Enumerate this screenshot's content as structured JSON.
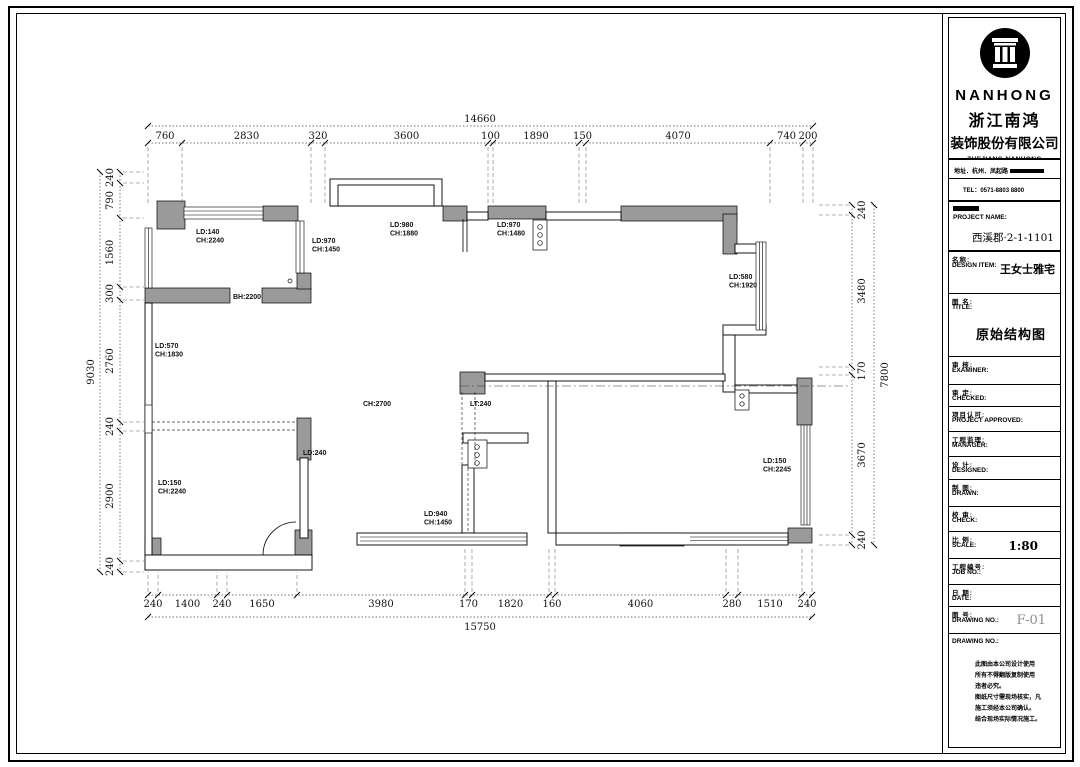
{
  "company": {
    "name_en": "NANHONG",
    "name_cn_1": "浙江南鸿",
    "name_cn_2": "装饰股份有限公司",
    "full_en_1": "ZHEJIANG NANHONG",
    "full_en_2": "INTERIOR DESIGN &",
    "full_en_3": "CONSTRUCTION CO.,LTD",
    "address": "地址．杭州．凤起路",
    "tel": "TEL：0571-8803 8800"
  },
  "fields": {
    "project_name_label": "PROJECT NAME:",
    "project_name_value": "西溪郡·2-1-1101",
    "design_item_cn": "名称:",
    "design_item_en": "DESIGN ITEM:",
    "design_item_value": "王女士雅宅",
    "title_cn": "图 名:",
    "title_en": "TITLE:",
    "title_value": "原始结构图",
    "examiner_cn": "审 核:",
    "examiner_en": "EXAMINER:",
    "checked_cn": "审 定:",
    "checked_en": "CHECKED:",
    "approved_cn": "项目认可:",
    "approved_en": "PROJECT APPROVED:",
    "manager_cn": "工程监理:",
    "manager_en": "MANAGER:",
    "designed_cn": "设 计:",
    "designed_en": "DESIGNED:",
    "drawn_cn": "制 图:",
    "drawn_en": "DRAWN:",
    "check_cn": "校 审:",
    "check_en": "CHECK:",
    "scale_cn": "比 例:",
    "scale_en": "SCALE:",
    "scale_value": "1:80",
    "job_cn": "工程编号:",
    "job_en": "JOB NO.:",
    "date_cn": "日 期:",
    "date_en": "DATE:",
    "dwg_cn": "图 号:",
    "dwg_en": "DRAWING NO.:",
    "dwg_value": "F-01",
    "notes_header": "DRAWING NO.:",
    "notes": "此图由本公司设计使用\n所有不得翻版复制使用\n违者必究。\n图纸尺寸需现场核实，凡\n施工须经本公司确认。\n结合现场实际情况施工。"
  },
  "plan": {
    "dims": {
      "top_total": "14660",
      "top": [
        "760",
        "2830",
        "320",
        "3600",
        "100",
        "1890",
        "150",
        "4070",
        "740",
        "200"
      ],
      "bottom": [
        "240",
        "1400",
        "240",
        "1650",
        "3980",
        "170",
        "1820",
        "160",
        "4060",
        "280",
        "1510",
        "240"
      ],
      "bottom_total": "15750",
      "left_total": "9030",
      "left": [
        "240",
        "790",
        "1560",
        "300",
        "2760",
        "240",
        "2900",
        "240"
      ],
      "right_total": "7800",
      "right": [
        "240",
        "3480",
        "170",
        "3670",
        "240"
      ]
    },
    "labels": [
      {
        "lines": [
          "LD:140",
          "CH:2240"
        ]
      },
      {
        "lines": [
          "LD:970",
          "CH:1450"
        ]
      },
      {
        "lines": [
          "LD:980",
          "CH:1880"
        ]
      },
      {
        "lines": [
          "LD:970",
          "CH:1480"
        ]
      },
      {
        "lines": [
          "LD:580",
          "CH:1920"
        ]
      },
      {
        "lines": [
          "BH:2200"
        ]
      },
      {
        "lines": [
          "LD:570",
          "CH:1830"
        ]
      },
      {
        "lines": [
          "CH:2700"
        ]
      },
      {
        "lines": [
          "LT:240"
        ]
      },
      {
        "lines": [
          "LD:240"
        ]
      },
      {
        "lines": [
          "LD:150",
          "CH:2240"
        ]
      },
      {
        "lines": [
          "LD:940",
          "CH:1450"
        ]
      },
      {
        "lines": [
          "LD:150",
          "CH:2245"
        ]
      }
    ]
  }
}
